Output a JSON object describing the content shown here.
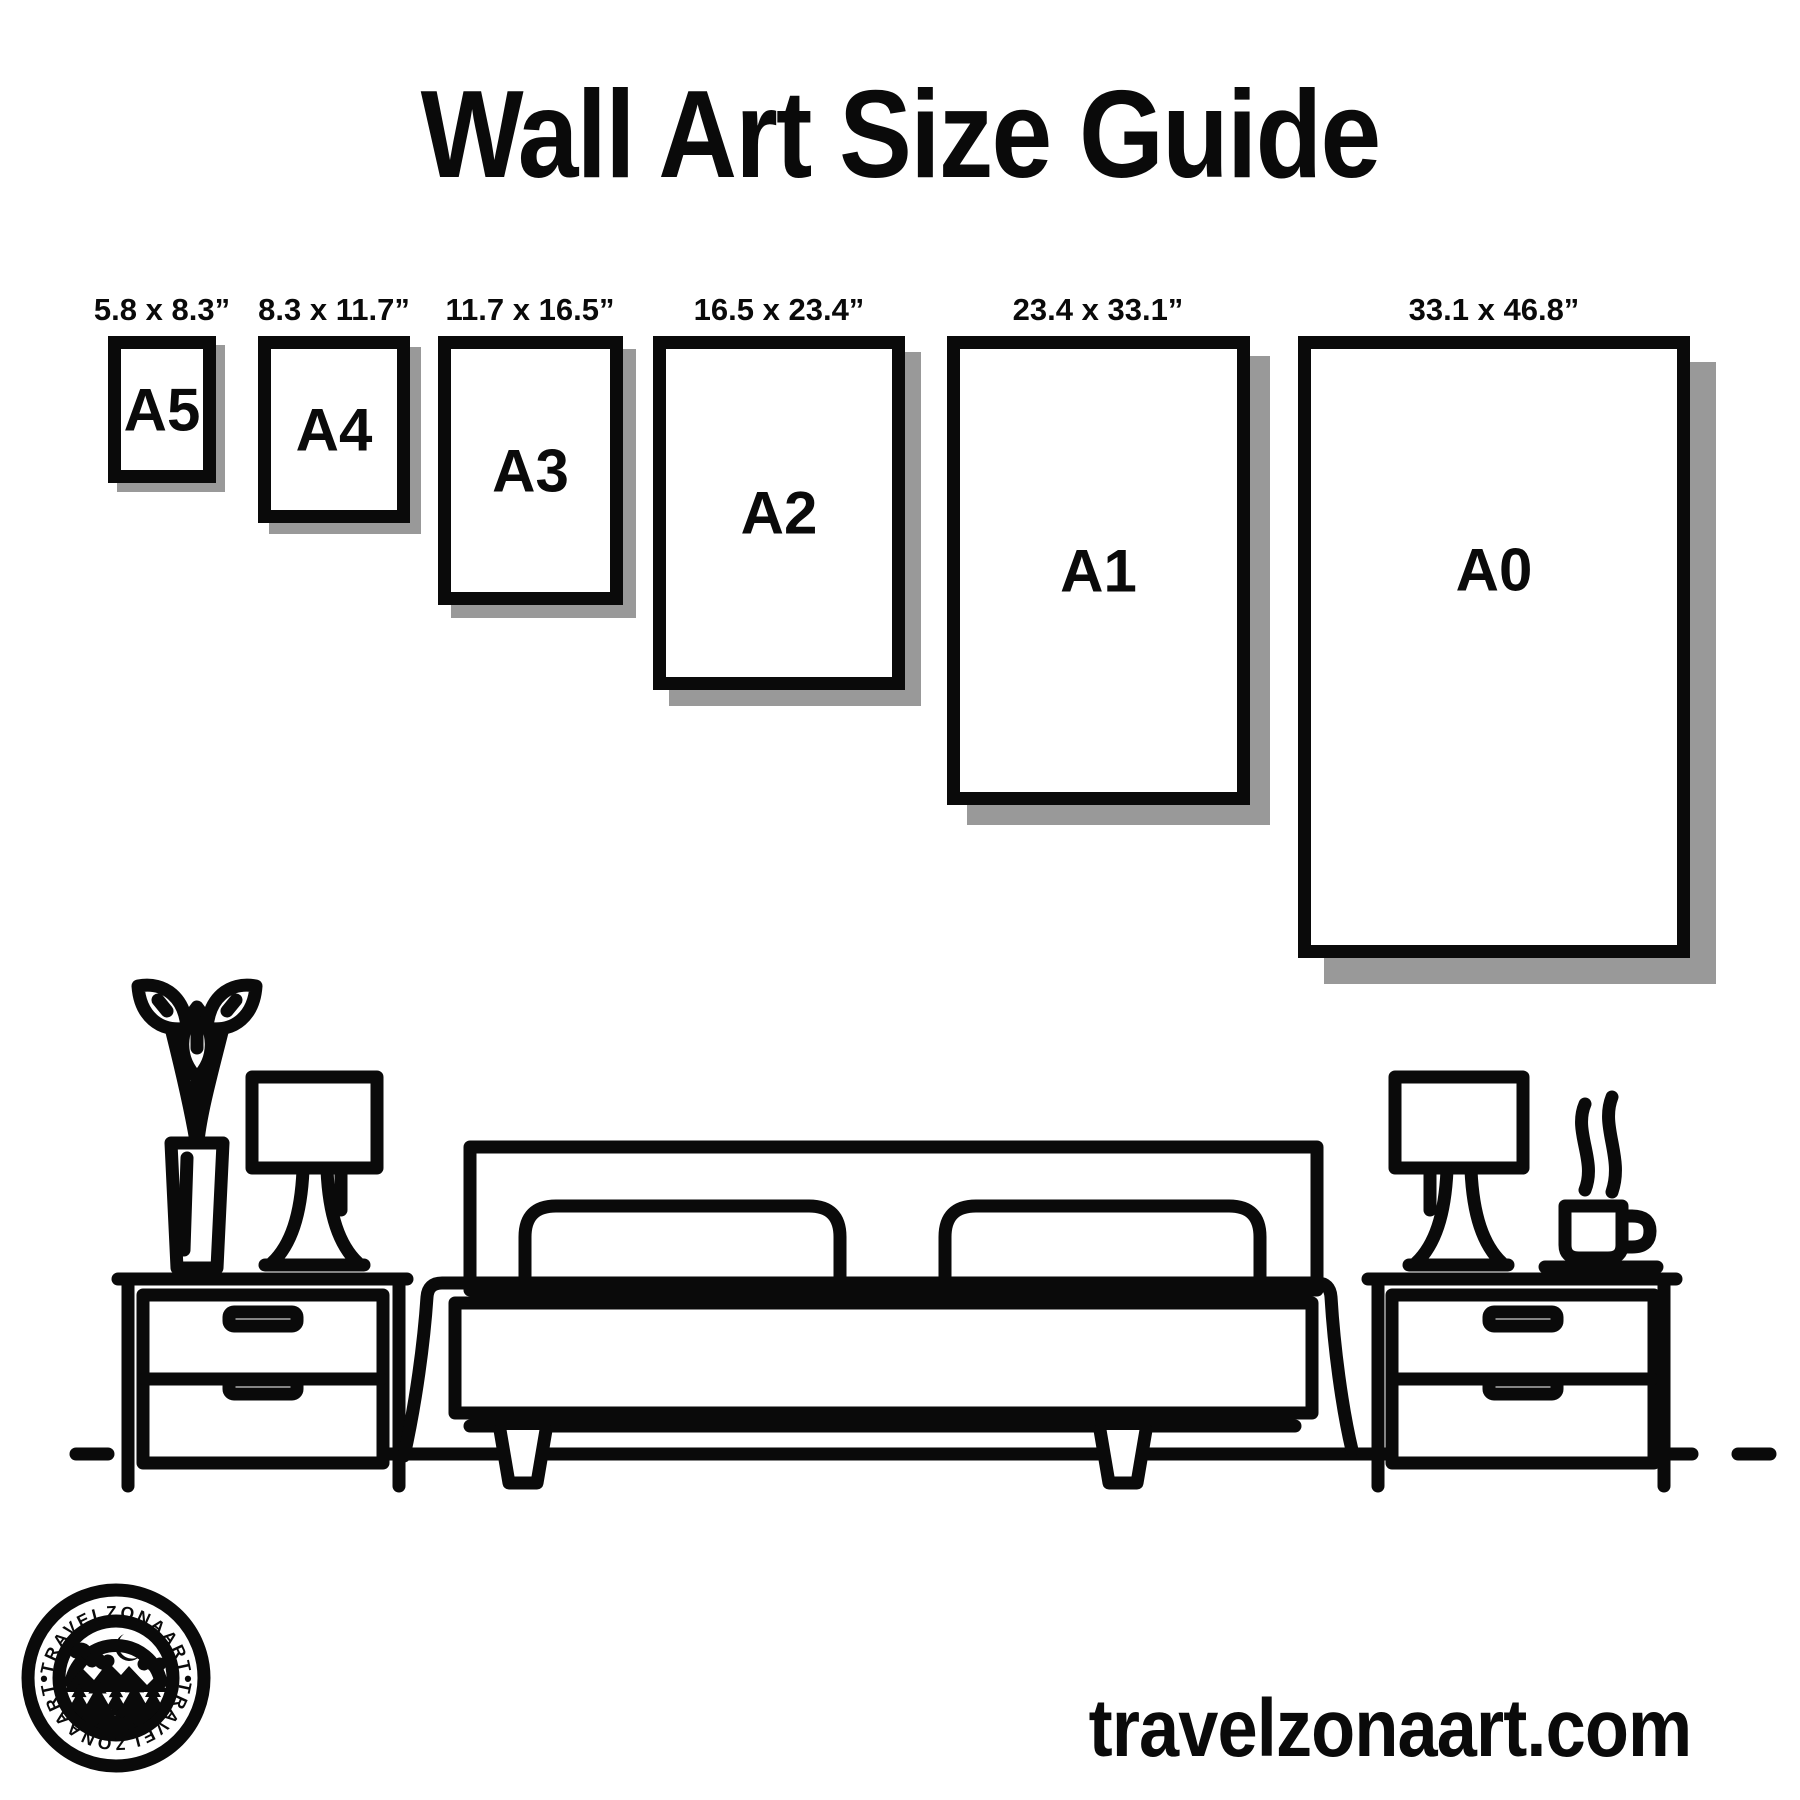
{
  "title": "Wall Art Size Guide",
  "sizes": [
    {
      "code": "A5",
      "dimensions": "5.8 x 8.3”"
    },
    {
      "code": "A4",
      "dimensions": "8.3 x 11.7”"
    },
    {
      "code": "A3",
      "dimensions": "11.7 x 16.5”"
    },
    {
      "code": "A2",
      "dimensions": "16.5 x 23.4”"
    },
    {
      "code": "A1",
      "dimensions": "23.4 x 33.1”"
    },
    {
      "code": "A0",
      "dimensions": "33.1 x 46.8”"
    }
  ],
  "logo": {
    "text_top": "TRAVELZONAART",
    "text_bottom": "TRAVELZONAART",
    "separator": "•"
  },
  "website": "travelzonaart.com",
  "colors": {
    "ink": "#0a0a0a",
    "shadow": "#999999",
    "background": "#ffffff"
  }
}
